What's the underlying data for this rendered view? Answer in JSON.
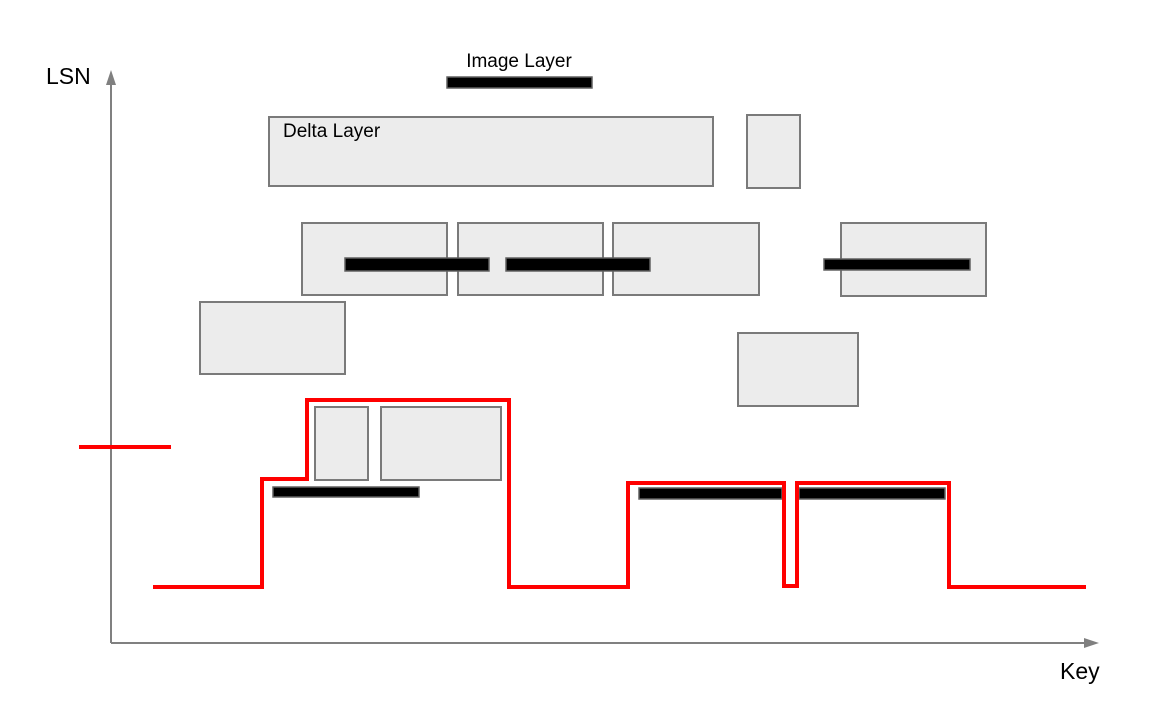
{
  "axes": {
    "y_label": "LSN",
    "x_label": "Key",
    "origin_x": 111,
    "origin_y": 643,
    "y_top": 70,
    "x_right": 1099
  },
  "legend": {
    "image_layer_label": "Image Layer",
    "delta_layer_label": "Delta Layer"
  },
  "colors": {
    "axis": "#808080",
    "rect_fill": "#ececec",
    "rect_border": "#7a7a7a",
    "bar_fill": "#000000",
    "bar_border": "#616161",
    "red": "#ff0000",
    "text": "#000000"
  },
  "diagram": {
    "delta_rects": [
      {
        "name": "delta-layer-rect-labeled",
        "x": 269,
        "y": 117,
        "w": 444,
        "h": 69
      },
      {
        "name": "delta-layer-rect-top-small",
        "x": 747,
        "y": 115,
        "w": 53,
        "h": 73
      },
      {
        "name": "delta-layer-rect-row2-a",
        "x": 302,
        "y": 223,
        "w": 145,
        "h": 72
      },
      {
        "name": "delta-layer-rect-row2-b",
        "x": 458,
        "y": 223,
        "w": 145,
        "h": 72
      },
      {
        "name": "delta-layer-rect-row2-c",
        "x": 613,
        "y": 223,
        "w": 146,
        "h": 72
      },
      {
        "name": "delta-layer-rect-row2-d",
        "x": 841,
        "y": 223,
        "w": 145,
        "h": 73
      },
      {
        "name": "delta-layer-rect-row3-left",
        "x": 200,
        "y": 302,
        "w": 145,
        "h": 72
      },
      {
        "name": "delta-layer-rect-row3-right",
        "x": 738,
        "y": 333,
        "w": 120,
        "h": 73
      },
      {
        "name": "delta-layer-rect-step-small",
        "x": 315,
        "y": 407,
        "w": 53,
        "h": 73
      },
      {
        "name": "delta-layer-rect-step-wide",
        "x": 381,
        "y": 407,
        "w": 120,
        "h": 73
      }
    ],
    "image_bars": [
      {
        "name": "image-layer-bar-legend",
        "x": 447,
        "y": 77,
        "w": 145,
        "h": 11
      },
      {
        "name": "image-layer-bar-row2-left",
        "x": 345,
        "y": 258,
        "w": 144,
        "h": 13
      },
      {
        "name": "image-layer-bar-row2-mid",
        "x": 506,
        "y": 258,
        "w": 144,
        "h": 13
      },
      {
        "name": "image-layer-bar-row2-right",
        "x": 824,
        "y": 259,
        "w": 146,
        "h": 11
      },
      {
        "name": "image-layer-bar-bottom-left",
        "x": 273,
        "y": 487,
        "w": 146,
        "h": 10
      },
      {
        "name": "image-layer-bar-bottom-mid",
        "x": 639,
        "y": 488,
        "w": 143,
        "h": 11
      },
      {
        "name": "image-layer-bar-bottom-right",
        "x": 799,
        "y": 488,
        "w": 146,
        "h": 11
      }
    ],
    "red_line_points": [
      [
        153,
        587
      ],
      [
        262,
        587
      ],
      [
        262,
        479
      ],
      [
        307,
        479
      ],
      [
        307,
        400
      ],
      [
        509,
        400
      ],
      [
        509,
        587
      ],
      [
        628,
        587
      ],
      [
        628,
        483
      ],
      [
        784,
        483
      ],
      [
        784,
        586
      ],
      [
        797,
        586
      ],
      [
        797,
        483
      ],
      [
        949,
        483
      ],
      [
        949,
        587
      ],
      [
        1086,
        587
      ]
    ],
    "red_tick": {
      "x1": 79,
      "y": 447,
      "x2": 171
    },
    "stroke_widths": {
      "red_line": 4,
      "axis": 2,
      "rect": 2,
      "bar": 1.5
    }
  }
}
